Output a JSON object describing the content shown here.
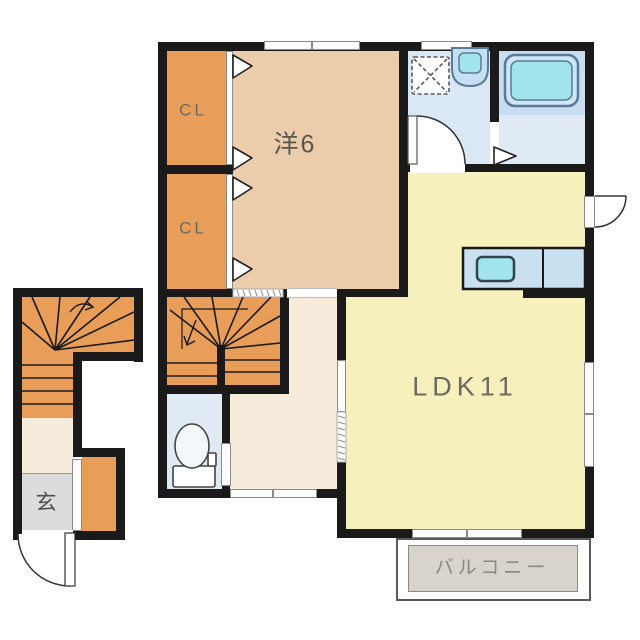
{
  "floorplan": {
    "rooms": {
      "closet_upper": {
        "label": "CL"
      },
      "closet_lower": {
        "label": "CL"
      },
      "western_room": {
        "label": "洋6"
      },
      "ldk": {
        "label": "LDK11"
      },
      "entrance": {
        "label": "玄"
      },
      "balcony": {
        "label": "バルコニー"
      }
    },
    "colors": {
      "wall": "#1a1a1a",
      "western_room_fill": "#eccdab",
      "ldk_fill": "#f6f0bd",
      "closet_and_stairs_fill": "#e89e58",
      "hallway_fill": "#f7ecdb",
      "wet_area_fill": "#d9e8f4",
      "bath_floor_fill": "#dfeaf5",
      "fixture_blue": "#c9e0f0",
      "fixture_cyan": "#a2e4ec",
      "entrance_gray": "#dcdcdc",
      "balcony_gray": "#d8d3cc",
      "label_gray": "#5f5f58"
    }
  }
}
